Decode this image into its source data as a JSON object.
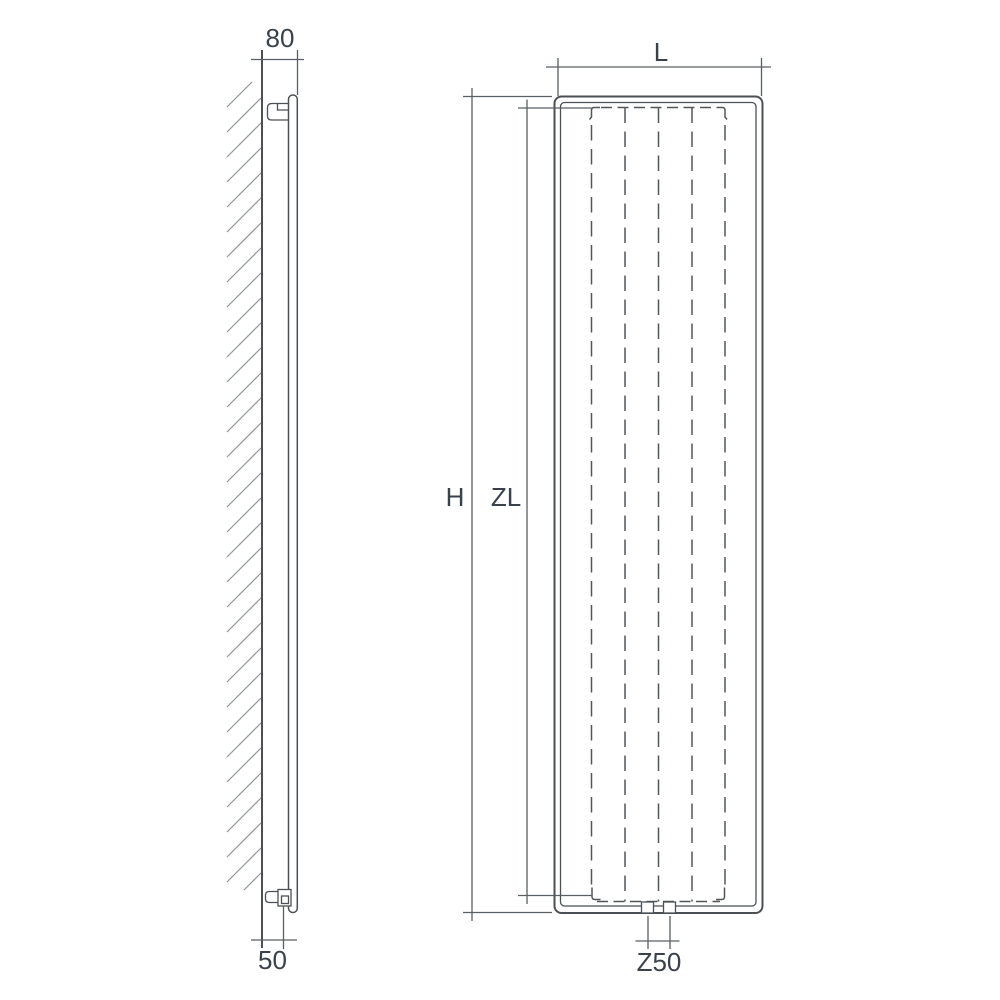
{
  "colors": {
    "background": "#ffffff",
    "object_line": "#4b5055",
    "dimension_line": "#5a5f64",
    "dashed_line": "#515659",
    "hatch_line": "#90959a",
    "label_text": "#39424c"
  },
  "side_view": {
    "dim_top": "80",
    "dim_bottom": "50"
  },
  "front_view": {
    "dim_width": "L",
    "dim_height": "H",
    "dim_inner_height": "ZL",
    "dim_connections": "Z50"
  }
}
